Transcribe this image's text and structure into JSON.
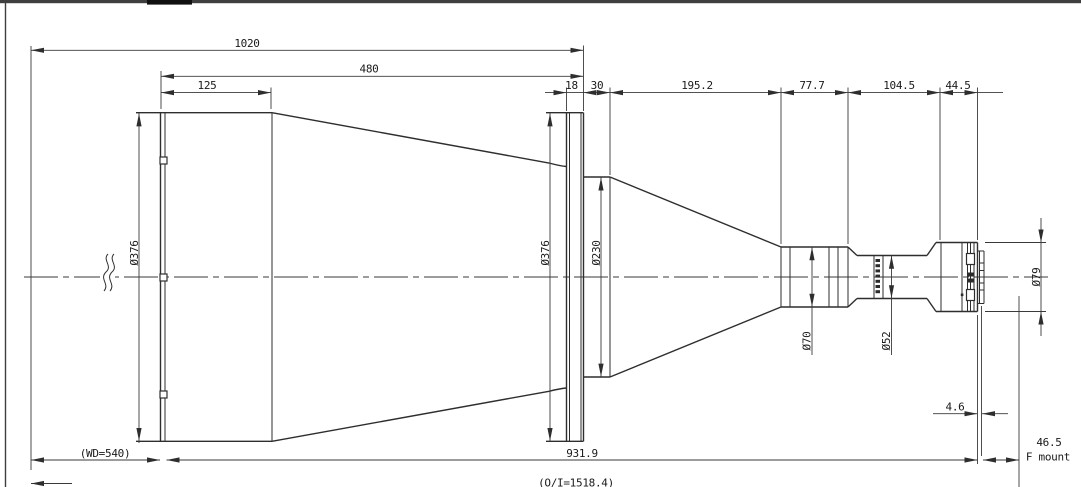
{
  "dims": {
    "top": {
      "overall": "1020",
      "front_housing": "480",
      "front_cap": "125",
      "flange_thickness": "18",
      "collar": "30",
      "cone": "195.2",
      "barrel1": "77.7",
      "barrel2": "104.5",
      "rear_mount": "44.5"
    },
    "bottom": {
      "working_distance": "(WD=540)",
      "lens_length": "931.9",
      "flange_offset": "4.6",
      "flange_focal": "46.5",
      "mount": "F mount",
      "object_image": "(O/I=1518.4)"
    },
    "diameters": {
      "front": "Ø376",
      "flange": "Ø376",
      "collar": "Ø230",
      "mid": "Ø70",
      "small": "Ø52",
      "rear": "Ø79"
    }
  },
  "colors": {
    "outline": "#2e2e2e",
    "dimension": "#3a3a3a",
    "border": "#3f3f3f",
    "background": "#ffffff"
  }
}
